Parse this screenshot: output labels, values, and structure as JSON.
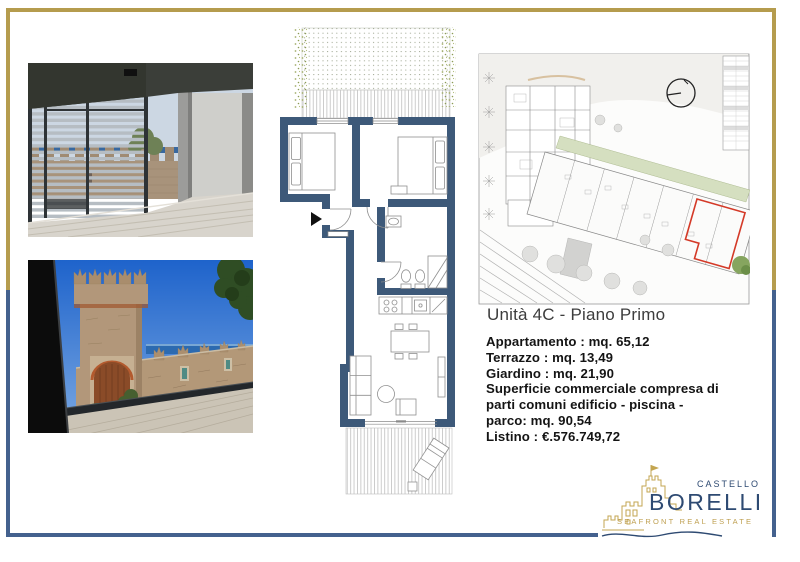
{
  "document": {
    "unit_title": "Unità 4C - Piano Primo",
    "details": [
      "Appartamento : mq. 65,12",
      "Terrazzo : mq. 13,49",
      "Giardino : mq. 21,90",
      "Superficie commerciale compresa di",
      "parti comuni edificio - piscina -",
      "parco: mq. 90,54",
      "Listino : €.576.749,72"
    ]
  },
  "brand": {
    "castello": "CASTELLO",
    "borelli": "BORELLI",
    "tagline": "SEAFRONT REAL ESTATE"
  },
  "colors": {
    "frame_gold": "#b59c4e",
    "frame_blue": "#44618e",
    "brand_blue": "#2e4a72",
    "brand_gold": "#c3a550",
    "plan_wall_blue": "#3d5979",
    "site_unit_highlight_red": "#d43a28"
  },
  "figures": {
    "photo_1": "terrace-interior-louvered-screen-castle-sea-view",
    "photo_2": "castle-battlement-walls-sea-view",
    "floor_plan": "unit-4c-floor-plan",
    "site_plan": "first-floor-site-plan-unit-4c-highlighted"
  }
}
